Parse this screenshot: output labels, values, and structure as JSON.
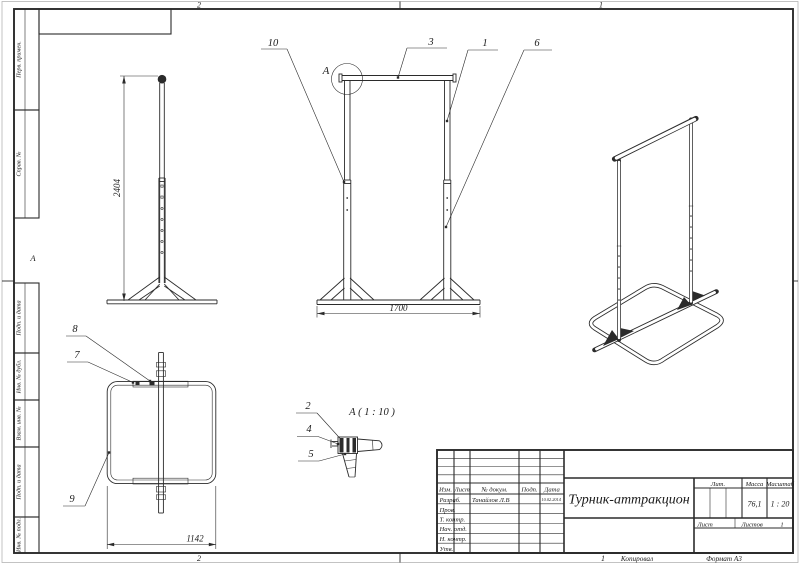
{
  "sheet": {
    "zones": {
      "top_left": "2",
      "top_right": "1",
      "bottom_left": "2",
      "bottom_right": "1",
      "left_middle": "А"
    },
    "copied_label": "Копировал",
    "format_label": "Формат А3",
    "side_labels": [
      "Перв. примен.",
      "Справ. №",
      "Подп. и дата",
      "Инв. № дубл.",
      "Взам. инв. №",
      "Подп. и дата",
      "Инв. № подл."
    ]
  },
  "title_block": {
    "doc_title": "Турник-аттракцион",
    "header": {
      "izm": "Изм.",
      "list": "Лист",
      "doc": "№ докум.",
      "sign": "Подп.",
      "date": "Дата"
    },
    "rows": [
      {
        "label": "Разраб.",
        "value": "Танайлов Л.В",
        "date": "10.02.2014"
      },
      {
        "label": "Пров."
      },
      {
        "label": "Т. контр."
      },
      {
        "label": "Нач. отд."
      },
      {
        "label": "Н. контр."
      },
      {
        "label": "Утв."
      }
    ],
    "lit_label": "Лит.",
    "mass_label": "Масса",
    "scale_label": "Масштаб",
    "mass_value": "76,1",
    "scale_value": "1 : 20",
    "sheet_label": "Лист",
    "sheets_label": "Листов",
    "sheets_value": "1"
  },
  "views": {
    "callouts": {
      "n1": "1",
      "n2": "2",
      "n3": "3",
      "n4": "4",
      "n5": "5",
      "n6": "6",
      "n7": "7",
      "n8": "8",
      "n9": "9",
      "n10": "10"
    },
    "detail_mark": "А",
    "detail_title": "А ( 1 : 10 )",
    "dims": {
      "height": "2404",
      "width": "1700",
      "base_width": "1142"
    }
  }
}
